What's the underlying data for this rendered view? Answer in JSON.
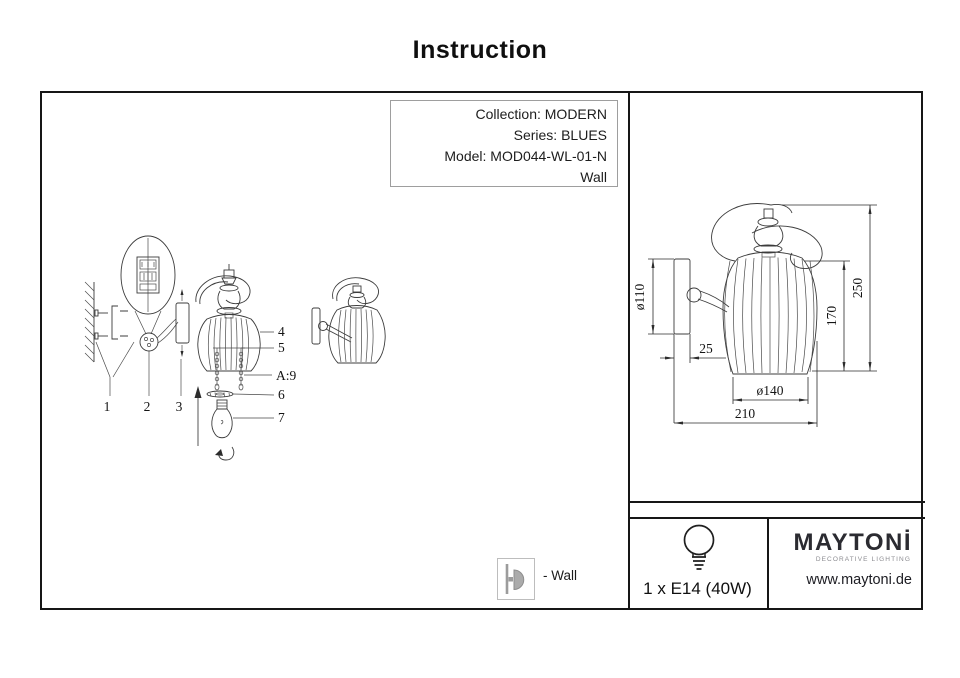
{
  "title": "Instruction",
  "info_box": {
    "collection": "Collection: MODERN",
    "series": "Series: BLUES",
    "model": "Model: MOD044-WL-01-N",
    "mount": "Wall"
  },
  "assembly": {
    "label_1": "1",
    "label_2": "2",
    "label_3": "3",
    "label_4": "4",
    "label_5": "5",
    "label_6": "6",
    "label_7": "7",
    "label_a9": "A:9"
  },
  "dimensions": {
    "plate_diameter": "ø110",
    "plate_depth": "25",
    "shade_diameter": "ø140",
    "total_width": "210",
    "shade_height": "170",
    "total_height": "250"
  },
  "footer": {
    "mount_label": "- Wall",
    "lamp_spec": "1 x E14 (40W)",
    "brand": "MAYTONİ",
    "brand_tagline": "DECORATIVE LIGHTING",
    "website": "www.maytoni.de"
  }
}
